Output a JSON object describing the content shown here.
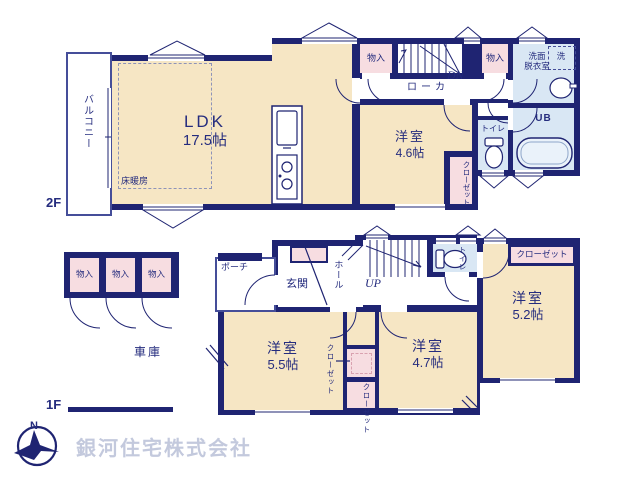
{
  "palette": {
    "wall": "#1f2472",
    "room_cream": "#f6e6c4",
    "closet_pink": "#f7dde1",
    "wet_blue": "#d9e7f4",
    "company_text": "#c3c9dd"
  },
  "company": "銀河住宅株式会社",
  "compass": {
    "north": "N"
  },
  "f2": {
    "label": "2F",
    "balcony": "バルコニー",
    "ldk_name": "LDK",
    "ldk_size": "17.5帖",
    "floor_heating": "床暖房",
    "storage_a": "物入",
    "storage_b": "物入",
    "corridor": "ローカ",
    "dn": "DN",
    "washroom_line1": "洗面",
    "washroom_line2": "脱衣室",
    "laundry": "洗",
    "ub": "UB",
    "toilet": "トイレ",
    "room_name": "洋室",
    "room_size": "4.6帖",
    "closet": "クローゼット"
  },
  "f1": {
    "label": "1F",
    "porch": "ポーチ",
    "entrance": "玄関",
    "hall": "ホール",
    "up": "UP",
    "toilet": "トイレ",
    "room_a_name": "洋室",
    "room_a_size": "5.5帖",
    "room_b_name": "洋室",
    "room_b_size": "4.7帖",
    "room_c_name": "洋室",
    "room_c_size": "5.2帖",
    "closet_a": "クローゼット",
    "closet_b": "クローゼット",
    "closet_c": "クローゼット",
    "storage": [
      "物入",
      "物入",
      "物入"
    ],
    "garage": "車庫"
  }
}
